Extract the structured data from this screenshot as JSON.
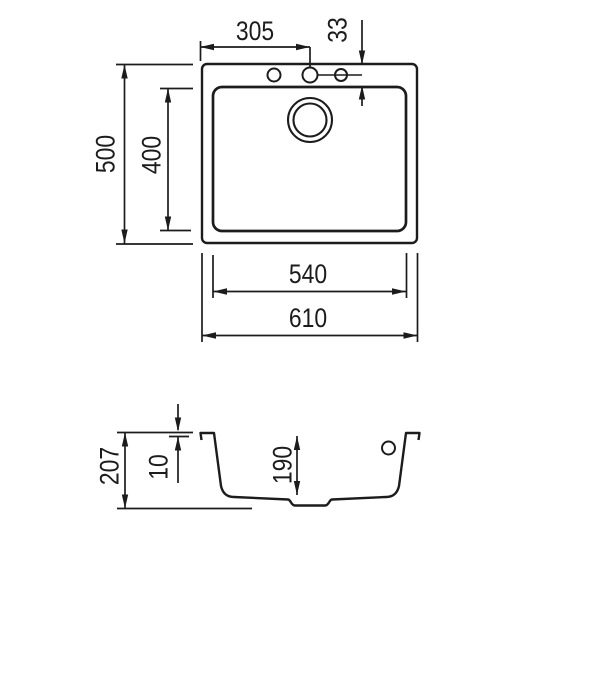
{
  "drawing": {
    "description": "sink-technical-drawing",
    "colors": {
      "line_color": "#1c1c1c",
      "background": "#ffffff"
    },
    "dimensions": {
      "top_view": {
        "tap_hole_center_from_left": "305",
        "tap_hole_center_from_rear": "33",
        "overall_depth": "500",
        "bowl_depth": "400",
        "bowl_width": "540",
        "overall_width": "610"
      },
      "section_view": {
        "overall_height": "207",
        "rim_thickness": "10",
        "bowl_inner_depth": "190"
      }
    }
  }
}
